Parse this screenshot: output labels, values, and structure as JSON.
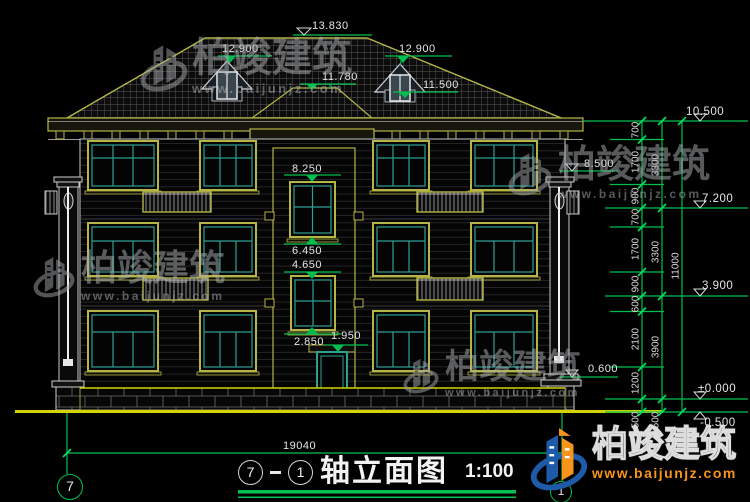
{
  "levels": {
    "l13830": "13.830",
    "l12900_left": "12.900",
    "l12900_right": "12.900",
    "l11780": "11.780",
    "l11500": "11.500",
    "l8500": "8.500",
    "l8250": "8.250",
    "l6450": "6.450",
    "l4650": "4.650",
    "l2850": "2.850",
    "l1950": "1.950",
    "l0600": "0.600",
    "r10500": "10.500",
    "r7200": "7.200",
    "r3900": "3.900",
    "r0000": "±0.000",
    "rm0500": "-0.500"
  },
  "chain": {
    "c1": [
      "700",
      "1700",
      "900",
      "700",
      "1700",
      "900",
      "600",
      "2100",
      "1200",
      "500"
    ],
    "c2": [
      "3300",
      "3300",
      "3900",
      "500"
    ],
    "total": "11000"
  },
  "plan": {
    "overall_width": "19040",
    "axis_left": "7",
    "axis_right": "1"
  },
  "title": {
    "bubble_left": "7",
    "bubble_right": "1",
    "text": "轴立面图",
    "scale": "1:100"
  },
  "watermark": {
    "brand": "柏竣建筑",
    "url": "www.baijunjz.com"
  },
  "colors": {
    "dim_green": "#00bf4f",
    "frame_yellow": "#b5b545",
    "mullion_teal": "#2f9e93",
    "ground_yellow": "#d4d400",
    "logo_blue": "#1d5aa8",
    "logo_orange": "#f7941d"
  }
}
